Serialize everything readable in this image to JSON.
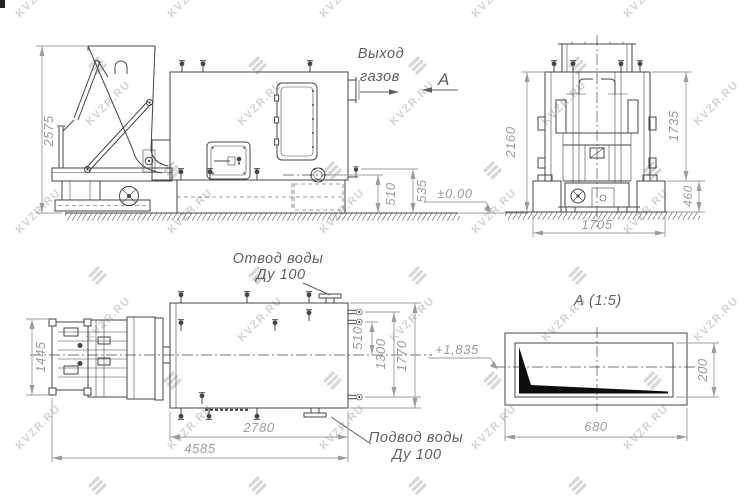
{
  "labels": {
    "gas_outlet_1": "Выход",
    "gas_outlet_2": "газов",
    "view_arrow": "А",
    "water_outlet_1": "Отвод воды",
    "water_outlet_2": "Ду 100",
    "water_inlet_1": "Подвод воды",
    "water_inlet_2": "Ду 100",
    "detail_title": "А  (1:5)",
    "elevation_zero": "±0.00",
    "elevation_grate": "+1,835"
  },
  "dimensions": {
    "side_view": {
      "overall_height": "2575",
      "flange_to_floor": "510",
      "drain_to_floor": "535"
    },
    "front_view": {
      "overall_height": "2160",
      "above_foundation": "1735",
      "foundation_depth": "460",
      "foundation_width": "1705"
    },
    "plan_view": {
      "drive_width": "1445",
      "port_to_axis": "510",
      "port_spacing": "1300",
      "body_width": "1770",
      "body_length": "2780",
      "overall_length": "4585"
    },
    "detail_view": {
      "grate_length": "680",
      "grate_height": "200"
    }
  },
  "watermark": {
    "text": "KVZR.RU"
  },
  "colors": {
    "line": "#454545",
    "dim": "#9c9c9c",
    "label": "#5f5f5f",
    "black_fill": "#0d0d0d",
    "watermark": "#bdbdbd",
    "background": "#ffffff"
  }
}
